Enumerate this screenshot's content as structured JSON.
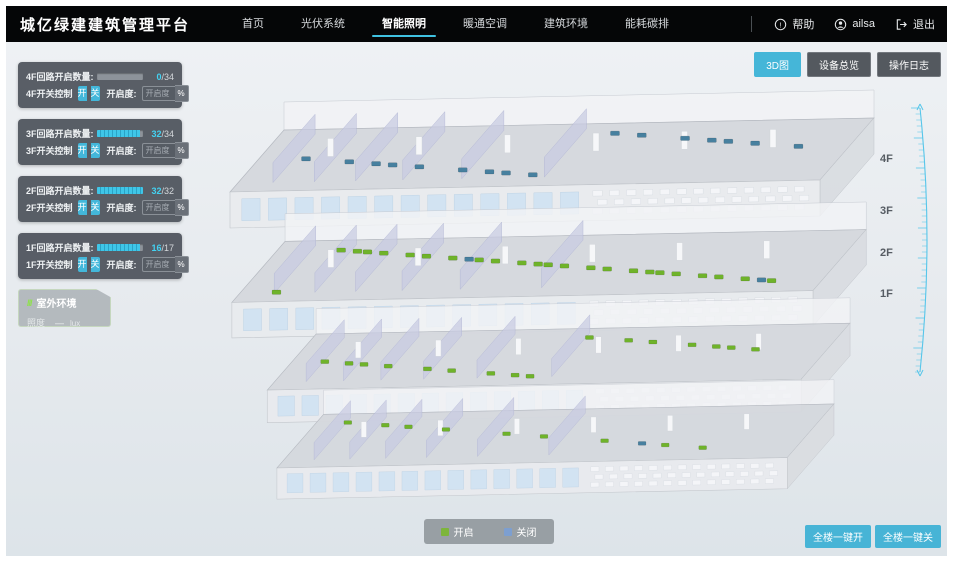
{
  "header": {
    "title": "城亿绿建建筑管理平台",
    "nav": [
      {
        "label": "首页",
        "active": false
      },
      {
        "label": "光伏系统",
        "active": false
      },
      {
        "label": "智能照明",
        "active": true
      },
      {
        "label": "暖通空调",
        "active": false
      },
      {
        "label": "建筑环境",
        "active": false
      },
      {
        "label": "能耗碳排",
        "active": false
      }
    ],
    "user": {
      "help_label": "帮助",
      "username": "ailsa",
      "logout_label": "退出"
    }
  },
  "view_buttons": [
    {
      "label": "3D图",
      "active": true
    },
    {
      "label": "设备总览",
      "active": false
    },
    {
      "label": "操作日志",
      "active": false
    }
  ],
  "floor_panels": [
    {
      "floor": "4F",
      "count_label": "4F回路开启数量:",
      "open": 0,
      "total": 34,
      "switch_label": "4F开关控制",
      "on_label": "开",
      "off_label": "关",
      "dim_label": "开启度:",
      "dim_placeholder": "开启度",
      "percent_label": "%"
    },
    {
      "floor": "3F",
      "count_label": "3F回路开启数量:",
      "open": 32,
      "total": 34,
      "switch_label": "3F开关控制",
      "on_label": "开",
      "off_label": "关",
      "dim_label": "开启度:",
      "dim_placeholder": "开启度",
      "percent_label": "%"
    },
    {
      "floor": "2F",
      "count_label": "2F回路开启数量:",
      "open": 32,
      "total": 32,
      "switch_label": "2F开关控制",
      "on_label": "开",
      "off_label": "关",
      "dim_label": "开启度:",
      "dim_placeholder": "开启度",
      "percent_label": "%"
    },
    {
      "floor": "1F",
      "count_label": "1F回路开启数量:",
      "open": 16,
      "total": 17,
      "switch_label": "1F开关控制",
      "on_label": "开",
      "off_label": "关",
      "dim_label": "开启度:",
      "dim_placeholder": "开启度",
      "percent_label": "%"
    }
  ],
  "outdoor": {
    "title": "室外环境",
    "icon": "///",
    "metric_label": "照度",
    "value": "—",
    "unit": "lux"
  },
  "building": {
    "floor_labels": [
      "4F",
      "3F",
      "2F",
      "1F"
    ],
    "floors": [
      {
        "name": "4F",
        "markers_on": 0,
        "markers_off": 16
      },
      {
        "name": "3F",
        "markers_on": 24,
        "markers_off": 2
      },
      {
        "name": "2F",
        "markers_on": 16,
        "markers_off": 0
      },
      {
        "name": "1F",
        "markers_on": 9,
        "markers_off": 1
      }
    ]
  },
  "legend": [
    {
      "label": "开启",
      "color": "#7db53b"
    },
    {
      "label": "关闭",
      "color": "#7d9fd0"
    }
  ],
  "global_buttons": [
    {
      "label": "全楼一键开"
    },
    {
      "label": "全楼一键关"
    }
  ],
  "colors": {
    "accent": "#45b6d8",
    "marker_on": "#6fb32a",
    "marker_off": "#47809f",
    "ruler": "#56c6ea"
  }
}
